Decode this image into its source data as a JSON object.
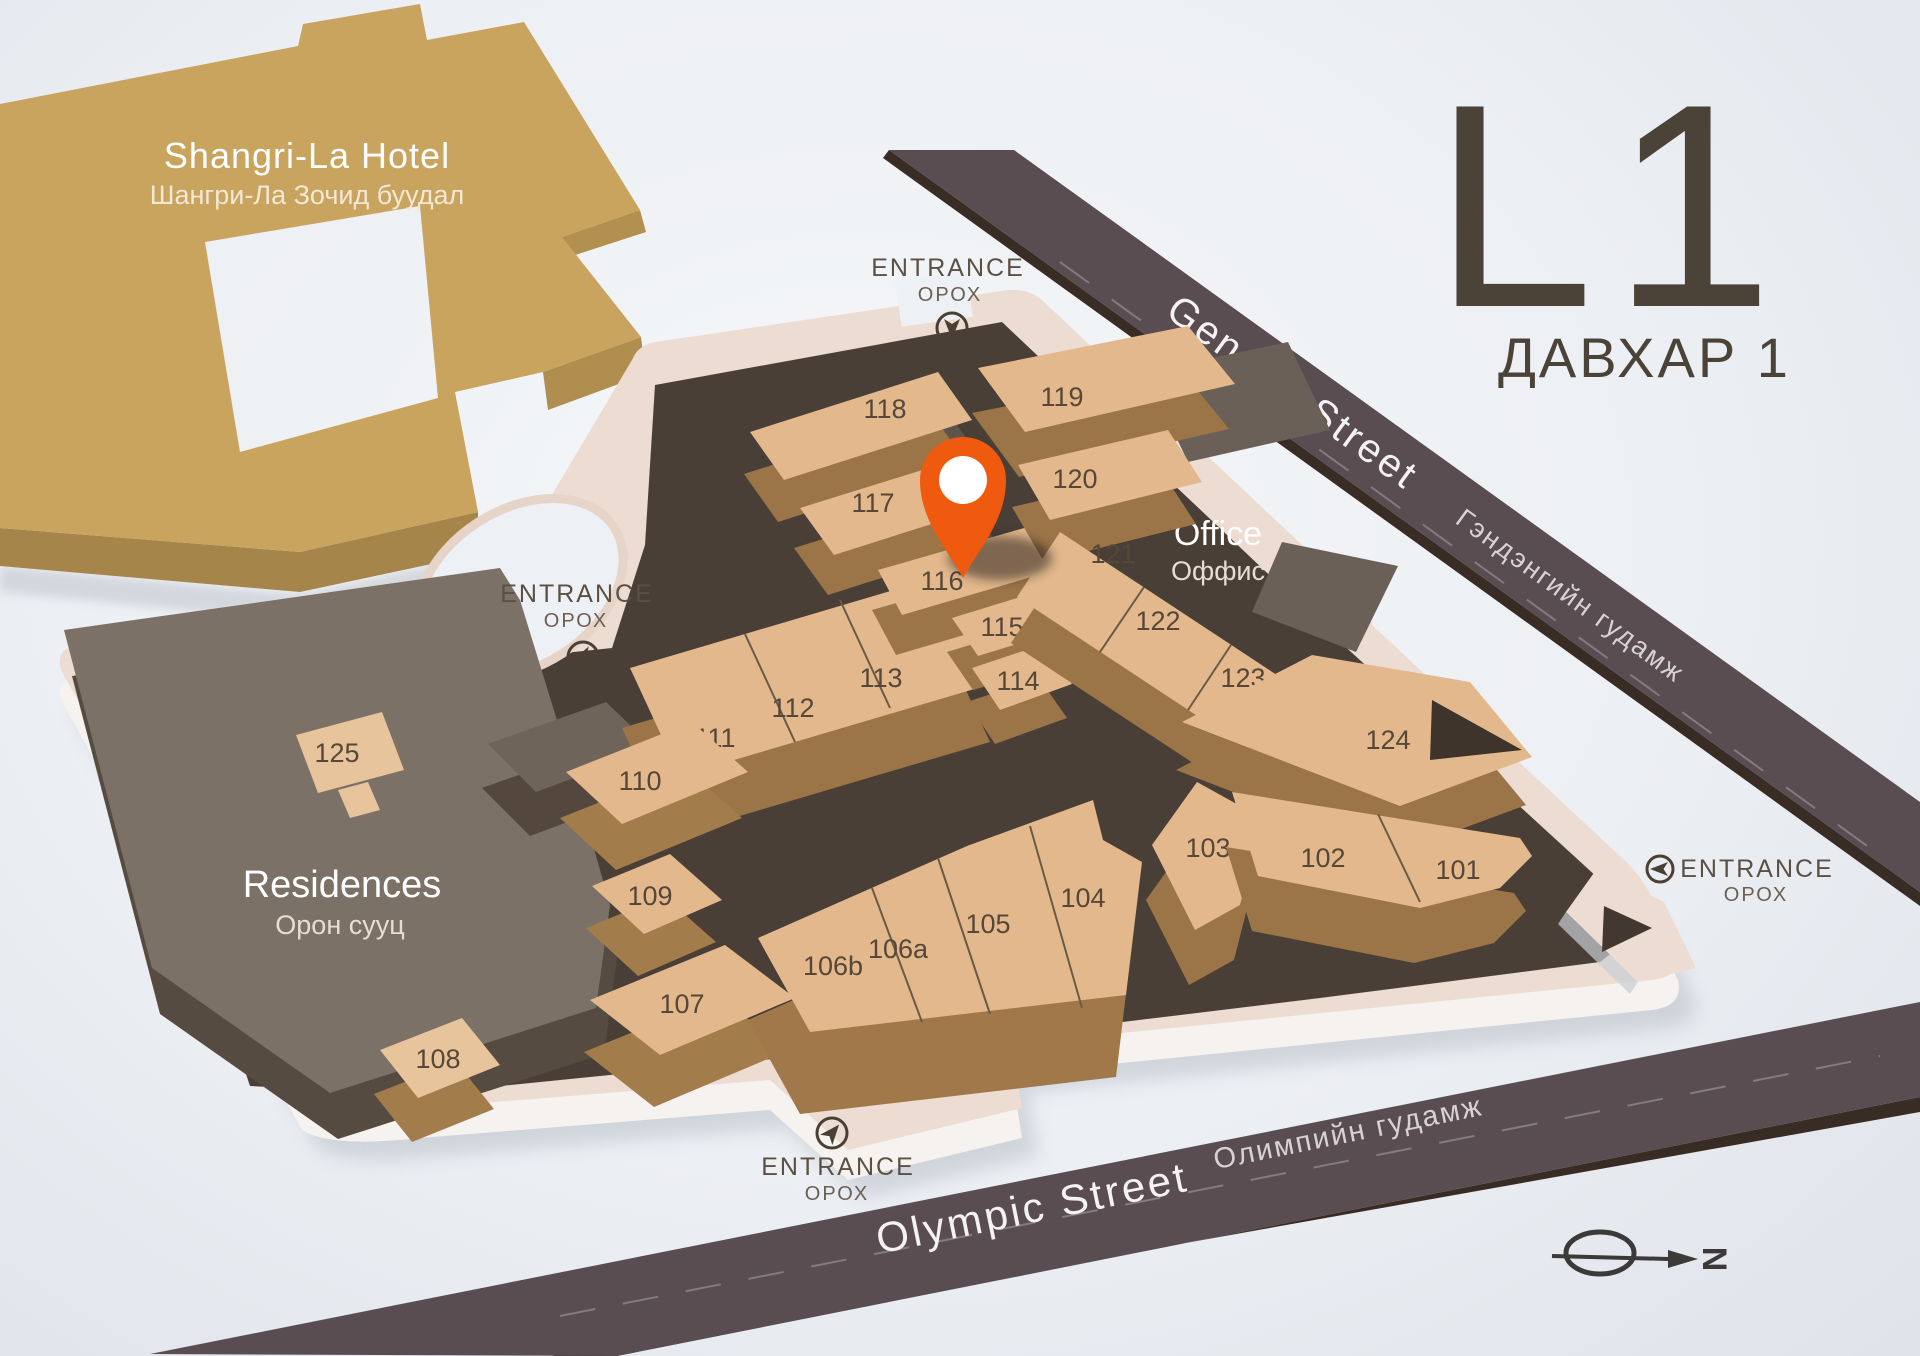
{
  "level": {
    "code": "L1",
    "name_mn": "ДАВХАР 1"
  },
  "hotel": {
    "name": "Shangri-La Hotel",
    "name_mn": "Шангри-Ла Зочид буудал"
  },
  "areas": {
    "residences": {
      "name": "Residences",
      "name_mn": "Орон сууц"
    },
    "office": {
      "name": "Office",
      "name_mn": "Оффис"
    }
  },
  "streets": {
    "genden": {
      "name": "Genden Street",
      "name_mn": "Гэндэнгийн гудамж"
    },
    "olympic": {
      "name": "Olympic Street",
      "name_mn": "Олимпийн гудамж"
    }
  },
  "entrance": {
    "label": "ENTRANCE",
    "label_mn": "ОРОХ"
  },
  "compass": {
    "north": "N"
  },
  "marker": {
    "name": "current-location-pin",
    "color": "#F05A0E"
  },
  "units": {
    "u101": "101",
    "u102": "102",
    "u103": "103",
    "u104": "104",
    "u105": "105",
    "u106a": "106a",
    "u106b": "106b",
    "u107": "107",
    "u108": "108",
    "u109": "109",
    "u110": "110",
    "u111": "111",
    "u112": "112",
    "u113": "113",
    "u114": "114",
    "u115": "115",
    "u116": "116",
    "u117": "117",
    "u118": "118",
    "u119": "119",
    "u120": "120",
    "u121": "121",
    "u122": "122",
    "u123": "123",
    "u124": "124",
    "u125": "125"
  },
  "colors": {
    "accent_orange": "#F05A0E",
    "hotel_gold": "#C8A45F",
    "unit_tan": "#E2B88C",
    "floor_dark": "#4A3F37",
    "street": "#594D51",
    "platform": "#ECDCD2",
    "residences_gray": "#7C7166",
    "label_brown": "#4B4238"
  }
}
